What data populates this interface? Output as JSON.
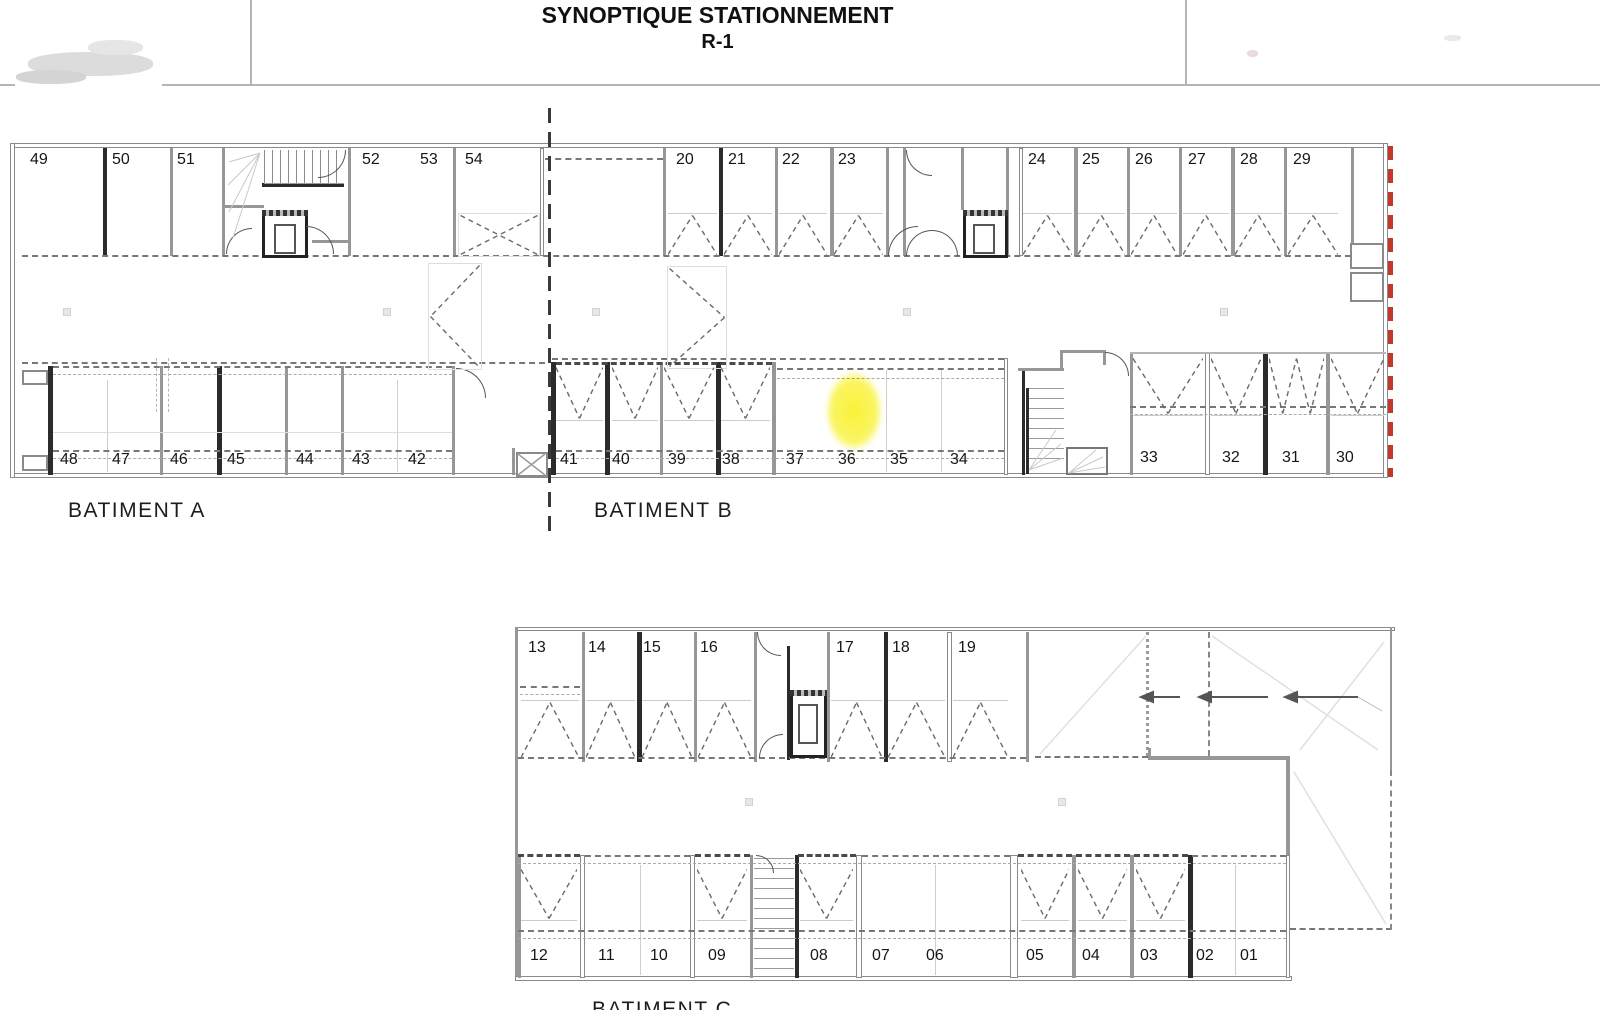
{
  "title_block": {
    "title": "SYNOPTIQUE STATIONNEMENT",
    "level": "R-1"
  },
  "labels": {
    "batiment_a": "BATIMENT A",
    "batiment_b": "BATIMENT B",
    "batiment_c": "BATIMENT C"
  },
  "upper_building": {
    "top_row_spaces": [
      "49",
      "50",
      "51",
      "52",
      "53",
      "54",
      "20",
      "21",
      "22",
      "23",
      "24",
      "25",
      "26",
      "27",
      "28",
      "29"
    ],
    "bottom_row_spaces": [
      "48",
      "47",
      "46",
      "45",
      "44",
      "43",
      "42",
      "41",
      "40",
      "39",
      "38",
      "37",
      "36",
      "35",
      "34",
      "33",
      "32",
      "31",
      "30"
    ],
    "highlighted_space": "36"
  },
  "lower_building": {
    "top_row_spaces": [
      "13",
      "14",
      "15",
      "16",
      "17",
      "18",
      "19"
    ],
    "bottom_row_spaces": [
      "12",
      "11",
      "10",
      "09",
      "08",
      "07",
      "06",
      "05",
      "04",
      "03",
      "02",
      "01"
    ]
  },
  "colors": {
    "highlight_yellow": "#f9f23a",
    "boundary_red": "#c2392b",
    "wall_gray": "#979797",
    "line_dark": "#2b2b2b"
  }
}
